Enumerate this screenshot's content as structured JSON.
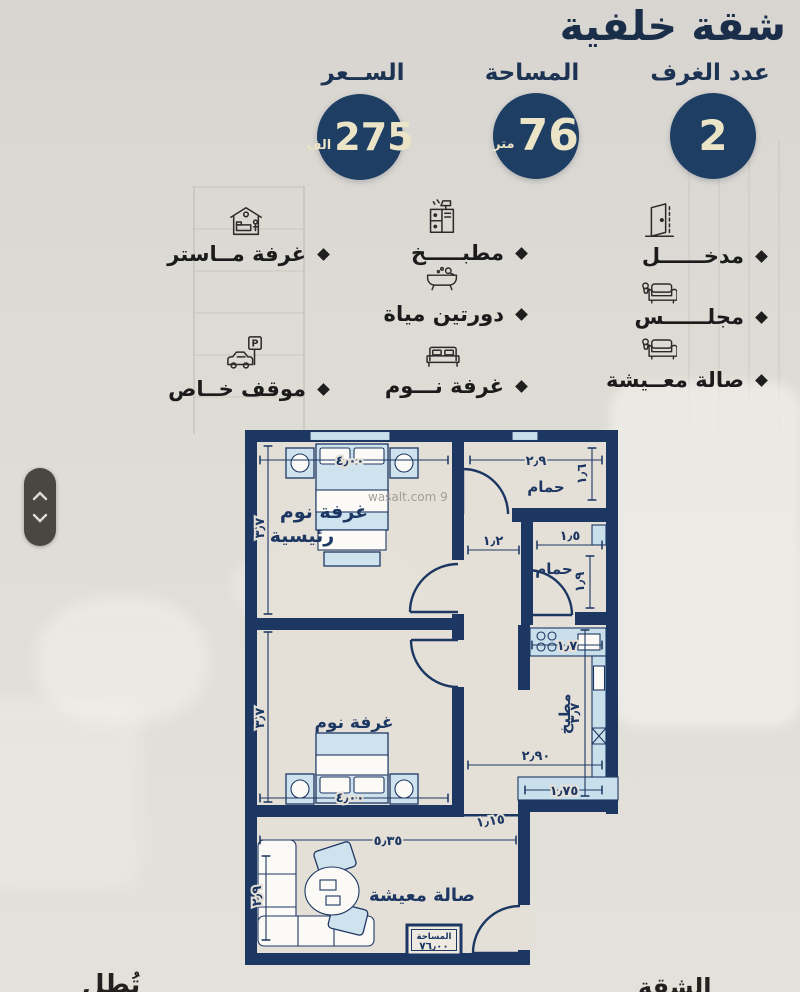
{
  "header": {
    "title": "شقة خلفية"
  },
  "stats": {
    "price": {
      "label": "الســعر",
      "value": "275",
      "unit": "الف"
    },
    "area": {
      "label": "المساحة",
      "value": "76",
      "unit": "متر"
    },
    "rooms": {
      "label": "عدد الغرف",
      "value": "2"
    }
  },
  "features": [
    {
      "id": "entrance",
      "label": "مدخــــــل",
      "icon": "door-icon"
    },
    {
      "id": "majlis",
      "label": "مجلــــــس",
      "icon": "sofa-icon"
    },
    {
      "id": "living-room",
      "label": "صالة معــيشة",
      "icon": "sofa-icon"
    },
    {
      "id": "kitchen",
      "label": "مطبـــــخ",
      "icon": "kitchen-icon"
    },
    {
      "id": "two-bathrooms",
      "label": "دورتين مياة",
      "icon": "bathtub-icon"
    },
    {
      "id": "bedroom",
      "label": "غرفة نـــوم",
      "icon": "bed-icon"
    },
    {
      "id": "master-room",
      "label": "غرفة مــاستر",
      "icon": "master-bed-icon"
    },
    {
      "id": "private-parking",
      "label": "موقف خــاص",
      "icon": "parking-icon"
    }
  ],
  "parking_sign_letter": "P",
  "floor_plan": {
    "watermark": "wasalt.com 9",
    "rooms": {
      "master_line1": "غرفة نوم",
      "master_line2": "رئيسية",
      "bathroom1": "حمام",
      "bathroom2": "حمام",
      "bedroom2": "غرفة نوم",
      "kitchen": "مطبخ",
      "living": "صالة معيشة"
    },
    "area_box": {
      "label": "المساحة",
      "value": "٧٦٫٠٠"
    },
    "dims": {
      "master_top": "٤٫٠٠",
      "master_left": "٣٫٧",
      "bath1_top": "٢٫٩",
      "bath1_right": "١٫٦",
      "hall": "١٫٢",
      "bath2_top": "١٫٥",
      "bath2_right": "١٫٩",
      "kitchen_top": "١٫٧",
      "kitchen_right": "٣٫٧",
      "corridor": "٢٫٩٠",
      "counter": "١٫٧٥",
      "passage": "١٫١٥",
      "living_top": "٥٫٣٥",
      "bed2_left": "٣٫٧",
      "bed2_bottom": "٤٫٠٠",
      "living_left": "٢٫٩"
    }
  },
  "fragments": {
    "left": "تُطل",
    "right": "الشقة"
  },
  "colors": {
    "navy": "#1d3763",
    "cream": "#ece4c6",
    "page_bg": "#dcd8d2",
    "furniture_blue": "#cfe3ee"
  }
}
